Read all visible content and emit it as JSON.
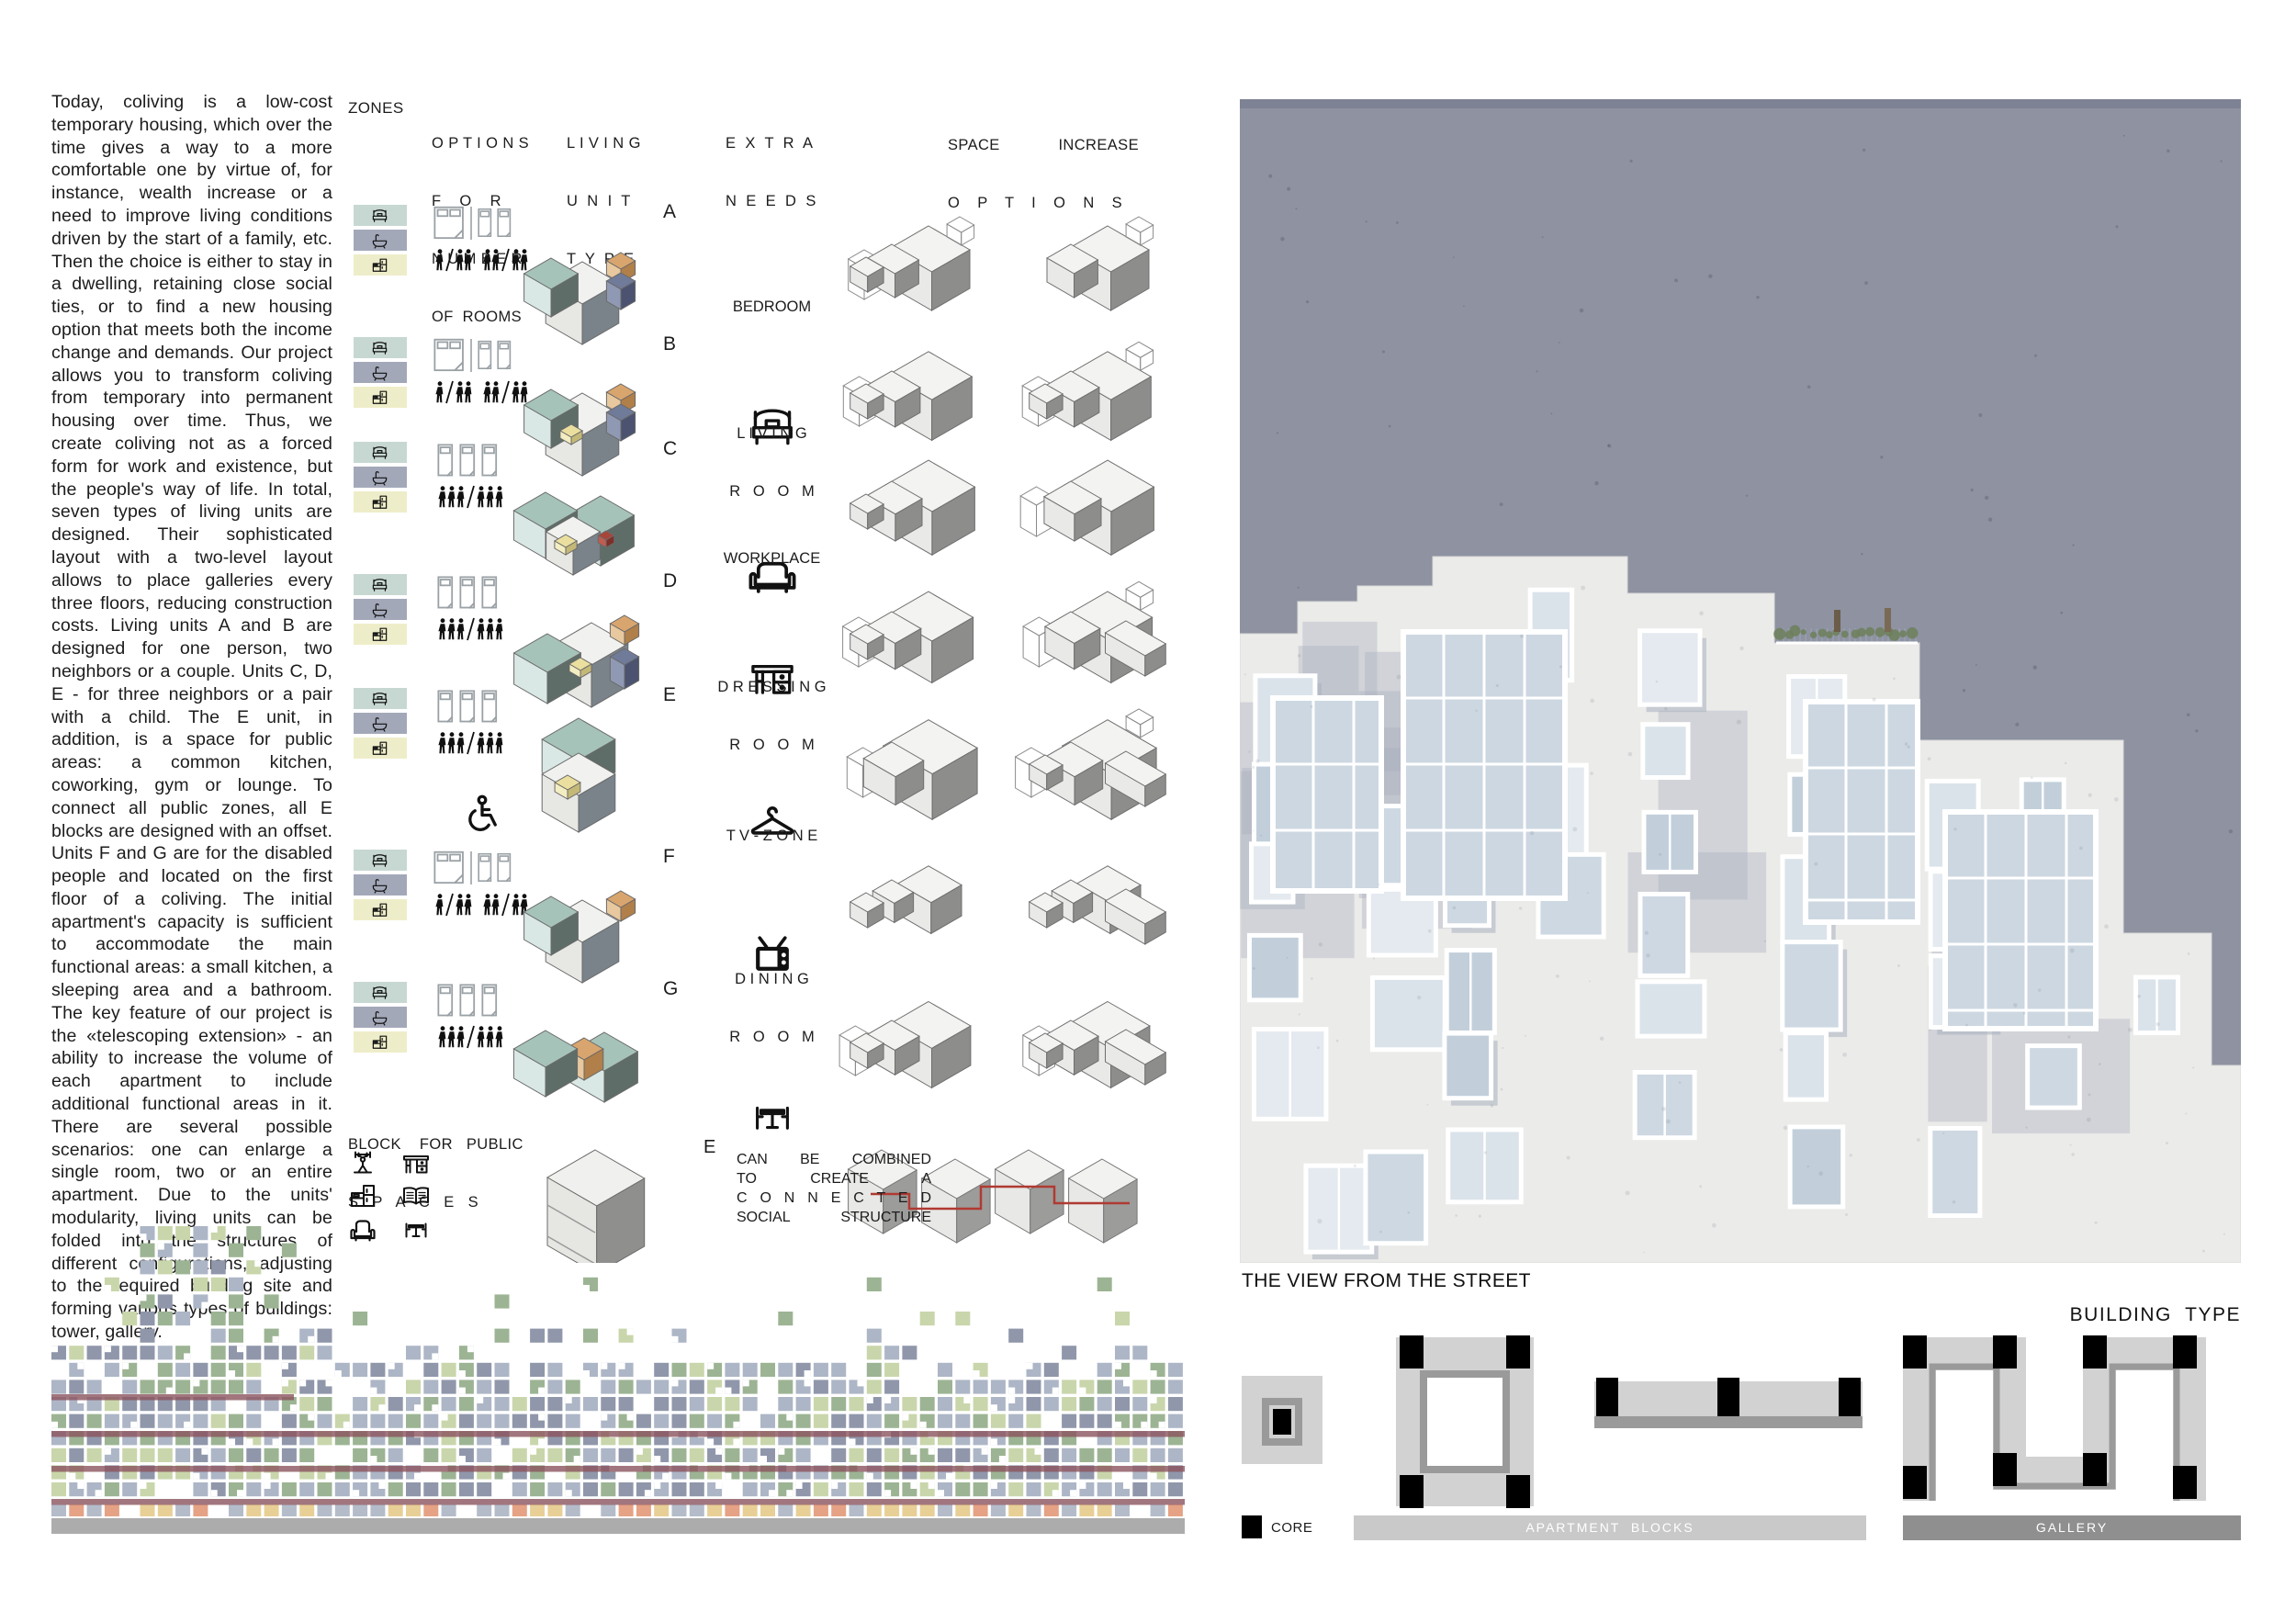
{
  "intro": {
    "text": "Today, coliving is a low-cost temporary housing, which over the time gives a way to a more comfortable one by virtue of, for instance, wealth increase or a need to improve living conditions driven by the start of a family, etc. Then the choice is either to stay in a dwelling, retaining close social ties, or to find a new housing option that meets both the income change and demands. Our project allows you to transform coliving from temporary into permanent housing over time. Thus, we create coliving not as a forced form for work and existence, but the people's way of life. In total, seven types of living units are designed. Their sophisticated layout with a two-level layout allows to place galleries every three floors, reducing construction costs. Living units A and B are designed for one person, two neighbors or a couple. Units C, D, E - for three neighbors or a pair with a child. The E unit, in addition, is a space for public areas: a common kitchen, coworking, gym or lounge. To connect all public zones, all E blocks are designed with an offset. Units F and G are for the disabled people and located on the first floor of a coliving. The initial apartment's capacity is sufficient to accommodate the main functional areas: a small kitchen, a sleeping area and a bathroom. The key feature of our project is the «telescoping extension» -  an ability to increase the volume of each apartment to include additional functional areas in it. There are several possible scenarios: one can enlarge a single room, two or an entire apartment. Due to the units' modularity, living units can be folded into the structures of different configurations, adjusting to the required building site and forming various types of buildings: tower, gallery."
  },
  "headers": {
    "zones": "ZONES",
    "options": [
      "O P T I O N S",
      "F    O    R",
      "N U M B E R",
      "OF  ROOMS"
    ],
    "living_unit": [
      "L I V I N G",
      "U  N  I  T",
      "T  Y  P  E"
    ],
    "extra_needs": [
      "E  X  T  R  A",
      "N  E  E  D  S"
    ],
    "space": "SPACE",
    "increase": "INCREASE",
    "options_spread": "O P T I O N S"
  },
  "zones": {
    "items": [
      {
        "name": "sleeping-zone",
        "color": "#c7d8d2",
        "icon": "bed-icon"
      },
      {
        "name": "bathroom-zone",
        "color": "#a3a8b9",
        "icon": "bathtub-icon"
      },
      {
        "name": "kitchen-zone",
        "color": "#eeedc9",
        "icon": "kitchen-icon"
      }
    ]
  },
  "units": [
    {
      "letter": "A",
      "rooms": "one-or-two"
    },
    {
      "letter": "B",
      "rooms": "one-or-two"
    },
    {
      "letter": "C",
      "rooms": "three"
    },
    {
      "letter": "D",
      "rooms": "three"
    },
    {
      "letter": "E",
      "rooms": "three"
    },
    {
      "letter": "F",
      "rooms": "one-or-two",
      "accessible": true
    },
    {
      "letter": "G",
      "rooms": "three",
      "accessible": true
    }
  ],
  "extra_needs": [
    {
      "lines": [
        "BEDROOM",
        ""
      ],
      "icon": "bed-icon"
    },
    {
      "lines": [
        "L I V I N G",
        "R   O   O   M"
      ],
      "icon": "sofa-icon"
    },
    {
      "lines": [
        "WORKPLACE",
        ""
      ],
      "icon": "desk-icon"
    },
    {
      "lines": [
        "D R E S S I N G",
        "R   O   O   M"
      ],
      "icon": "hanger-icon"
    },
    {
      "lines": [
        "T V - Z O N E",
        ""
      ],
      "icon": "tv-icon"
    },
    {
      "lines": [
        "D I N I N G",
        "R   O   O   M"
      ],
      "icon": "dining-table-icon"
    }
  ],
  "public_block": {
    "header": [
      "BLOCK    FOR   PUBLIC",
      "S   P   A   C   E   S"
    ],
    "icons": [
      "gym-icon",
      "desk-icon",
      "kitchen-icon",
      "library-icon",
      "armchair-icon",
      "dining-table-icon"
    ]
  },
  "combine": {
    "unit_letter": "E",
    "note": [
      "CAN BE COMBINED",
      "TO CREATE A",
      "C O N N E C T E D",
      "SOCIAL STRUCTURE"
    ]
  },
  "street_view": {
    "caption": "THE VIEW FROM THE STREET"
  },
  "building_type": {
    "title": "BUILDING  TYPE",
    "types": [
      "tower",
      "courtyard",
      "linear",
      "gallery-meander"
    ],
    "legend": {
      "core": "CORE",
      "apartment_blocks": "APARTMENT  BLOCKS",
      "gallery": "GALLERY"
    }
  },
  "palette": {
    "sky": "#8e92a1",
    "building": "#ebebe9",
    "window": "#ccd7e1",
    "shadow": "#a9b0bf",
    "gallery_line": "#8c5560",
    "base_bar": "#acacac",
    "mosaic": [
      "#9cb493",
      "#c9d6ab",
      "#adb6c6",
      "#9097ab"
    ],
    "mosaic_bottom": [
      "#e8cf96",
      "#e5a284",
      "#b4bcca"
    ],
    "diagram_light": "#d2d2d2",
    "diagram_mid": "#9a9a9a",
    "diagram_dark": "#8f8f8f",
    "core": "#000000",
    "apartment_bar": "#c9c9c9",
    "gallery_bar": "#8f8f8f"
  }
}
